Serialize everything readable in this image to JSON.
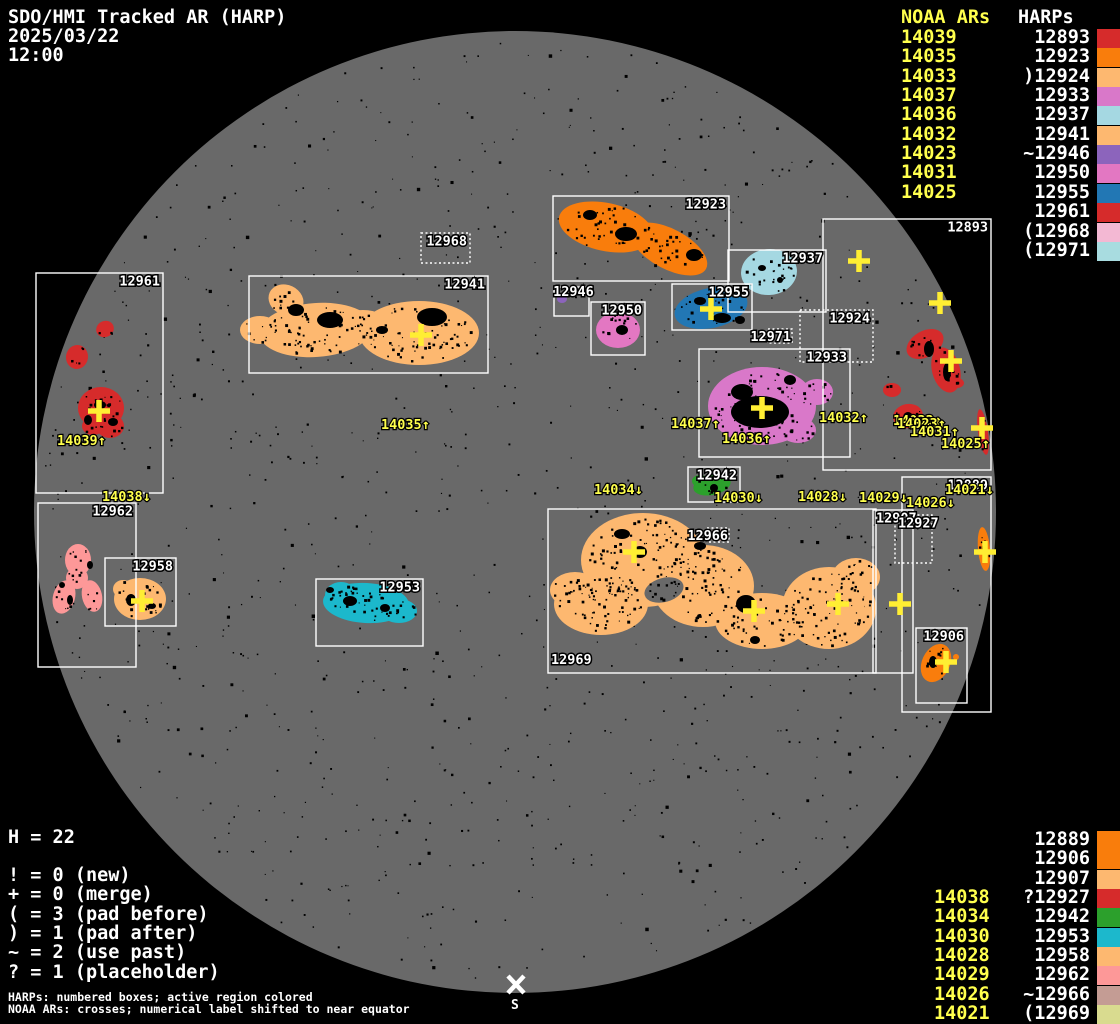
{
  "title": {
    "app": "SDO/HMI Tracked AR (HARP)",
    "date": "2025/03/22",
    "time": "12:00"
  },
  "top_legend": {
    "noaa_header": "NOAA ARs",
    "harp_header": "HARPs",
    "rows": [
      {
        "noaa": "14039",
        "prefix": "",
        "harp": "12893",
        "color": "#d62b2b"
      },
      {
        "noaa": "14035",
        "prefix": "",
        "harp": "12923",
        "color": "#f97d0c"
      },
      {
        "noaa": "14033",
        "prefix": ")",
        "harp": "12924",
        "color": "#fdb870"
      },
      {
        "noaa": "14037",
        "prefix": "",
        "harp": "12933",
        "color": "#d978c9"
      },
      {
        "noaa": "14036",
        "prefix": "",
        "harp": "12937",
        "color": "#a5d8e2"
      },
      {
        "noaa": "14032",
        "prefix": "",
        "harp": "12941",
        "color": "#fdb870"
      },
      {
        "noaa": "14023",
        "prefix": "~",
        "harp": "12946",
        "color": "#8c64bc"
      },
      {
        "noaa": "14031",
        "prefix": "",
        "harp": "12950",
        "color": "#e377c2"
      },
      {
        "noaa": "14025",
        "prefix": "",
        "harp": "12955",
        "color": "#2277b4"
      },
      {
        "noaa": "",
        "prefix": "",
        "harp": "12961",
        "color": "#d62b2b"
      },
      {
        "noaa": "",
        "prefix": "(",
        "harp": "12968",
        "color": "#f3b8d3"
      },
      {
        "noaa": "",
        "prefix": "(",
        "harp": "12971",
        "color": "#a8dce0"
      }
    ]
  },
  "bottom_legend": {
    "rows": [
      {
        "noaa": "",
        "prefix": "",
        "harp": "12889",
        "color": "#f97d0c"
      },
      {
        "noaa": "",
        "prefix": "",
        "harp": "12906",
        "color": "#f97d0c"
      },
      {
        "noaa": "",
        "prefix": "",
        "harp": "12907",
        "color": "#fdb870"
      },
      {
        "noaa": "14038",
        "prefix": "?",
        "harp": "12927",
        "color": "#d62b2b"
      },
      {
        "noaa": "14034",
        "prefix": "",
        "harp": "12942",
        "color": "#2ca02c"
      },
      {
        "noaa": "14030",
        "prefix": "",
        "harp": "12953",
        "color": "#1cb8cc"
      },
      {
        "noaa": "14028",
        "prefix": "",
        "harp": "12958",
        "color": "#fdb870"
      },
      {
        "noaa": "14029",
        "prefix": "",
        "harp": "12962",
        "color": "#fd9898"
      },
      {
        "noaa": "14026",
        "prefix": "~",
        "harp": "12966",
        "color": "#c49c94"
      },
      {
        "noaa": "14021",
        "prefix": "(",
        "harp": "12969",
        "color": "#d9db8f"
      }
    ]
  },
  "counters": {
    "h_line": "H = 22",
    "items": [
      "! = 0 (new)",
      "+ = 0 (merge)",
      "( = 3 (pad before)",
      ") = 1 (pad after)",
      "~ = 2 (use past)",
      "? = 1 (placeholder)"
    ]
  },
  "footnotes": {
    "line1": "HARPs: numbered boxes; active region colored",
    "line2": "NOAA ARs: crosses; numerical label shifted to near equator"
  },
  "south_label": "S",
  "disk": {
    "cx": 515,
    "cy": 512,
    "r": 481,
    "color": "#696969",
    "background": "#000000",
    "cross_color": "#ffee33",
    "label_color": "#ffff4d"
  },
  "boxes": [
    {
      "label": "12961",
      "x": 36,
      "y": 273,
      "w": 127,
      "h": 220,
      "dotted": false,
      "anchor": "tr"
    },
    {
      "label": "12962",
      "x": 38,
      "y": 503,
      "w": 98,
      "h": 164,
      "dotted": false,
      "anchor": "tr"
    },
    {
      "label": "12958",
      "x": 105,
      "y": 558,
      "w": 71,
      "h": 68,
      "dotted": false,
      "anchor": "tr"
    },
    {
      "label": "12941",
      "x": 249,
      "y": 276,
      "w": 239,
      "h": 97,
      "dotted": false,
      "anchor": "tr"
    },
    {
      "label": "12968",
      "x": 421,
      "y": 233,
      "w": 49,
      "h": 30,
      "dotted": true,
      "anchor": "tr"
    },
    {
      "label": "12923",
      "x": 553,
      "y": 196,
      "w": 176,
      "h": 85,
      "dotted": false,
      "anchor": "tr"
    },
    {
      "label": "12946",
      "x": 554,
      "y": 287,
      "w": 35,
      "h": 29,
      "dotted": false,
      "anchor": "tc"
    },
    {
      "label": "12950",
      "x": 591,
      "y": 302,
      "w": 54,
      "h": 53,
      "dotted": false,
      "anchor": "tr"
    },
    {
      "label": "12955",
      "x": 672,
      "y": 284,
      "w": 80,
      "h": 46,
      "dotted": false,
      "anchor": "tr"
    },
    {
      "label": "12937",
      "x": 728,
      "y": 250,
      "w": 98,
      "h": 62,
      "dotted": false,
      "anchor": "tr"
    },
    {
      "label": "12924",
      "x": 800,
      "y": 310,
      "w": 73,
      "h": 52,
      "dotted": true,
      "anchor": "tr"
    },
    {
      "label": "12933",
      "x": 699,
      "y": 349,
      "w": 151,
      "h": 108,
      "dotted": false,
      "anchor": "tr"
    },
    {
      "label": "12893",
      "x": 823,
      "y": 219,
      "w": 168,
      "h": 251,
      "dotted": false,
      "anchor": "tr"
    },
    {
      "label": "12971",
      "x": 768,
      "y": 329,
      "w": 24,
      "h": 14,
      "dotted": true,
      "anchor": "lr"
    },
    {
      "label": "12942",
      "x": 688,
      "y": 467,
      "w": 52,
      "h": 35,
      "dotted": false,
      "anchor": "tr"
    },
    {
      "label": "12969",
      "x": 548,
      "y": 509,
      "w": 328,
      "h": 164,
      "dotted": false,
      "anchor": "bl"
    },
    {
      "label": "12966",
      "x": 707,
      "y": 528,
      "w": 22,
      "h": 14,
      "dotted": true,
      "anchor": "lr"
    },
    {
      "label": "12953",
      "x": 316,
      "y": 579,
      "w": 107,
      "h": 67,
      "dotted": false,
      "anchor": "tr"
    },
    {
      "label": "12889",
      "x": 902,
      "y": 477,
      "w": 89,
      "h": 235,
      "dotted": false,
      "anchor": "tr"
    },
    {
      "label": "12907",
      "x": 873,
      "y": 510,
      "w": 40,
      "h": 163,
      "dotted": false,
      "anchor": "tl"
    },
    {
      "label": "12927",
      "x": 895,
      "y": 515,
      "w": 37,
      "h": 48,
      "dotted": true,
      "anchor": "tl"
    },
    {
      "label": "12906",
      "x": 916,
      "y": 628,
      "w": 51,
      "h": 75,
      "dotted": false,
      "anchor": "tr"
    }
  ],
  "regions": [
    {
      "name": "harp-12961",
      "color": "#d62b2b",
      "parts": [
        [
          105,
          329,
          9,
          8,
          -25
        ],
        [
          77,
          357,
          11,
          12,
          10
        ],
        [
          101,
          408,
          23,
          21,
          0
        ],
        [
          110,
          426,
          14,
          12,
          0
        ],
        [
          93,
          426,
          11,
          9,
          0
        ]
      ],
      "cores": [
        [
          100,
          405,
          6,
          4
        ],
        [
          88,
          420,
          4,
          5
        ],
        [
          113,
          422,
          5,
          4
        ]
      ]
    },
    {
      "name": "harp-12962",
      "color": "#fd9898",
      "parts": [
        [
          78,
          560,
          13,
          16,
          0
        ],
        [
          64,
          597,
          11,
          17,
          15
        ],
        [
          92,
          596,
          10,
          16,
          -12
        ],
        [
          77,
          578,
          11,
          11,
          0
        ]
      ],
      "cores": [
        [
          70,
          600,
          3,
          5
        ],
        [
          90,
          565,
          3,
          4
        ],
        [
          62,
          585,
          3,
          3
        ]
      ]
    },
    {
      "name": "harp-12958",
      "color": "#fdb870",
      "parts": [
        [
          140,
          599,
          26,
          21,
          0
        ],
        [
          123,
          589,
          10,
          9,
          0
        ]
      ],
      "cores": [
        [
          131,
          600,
          5,
          6
        ],
        [
          152,
          606,
          4,
          3
        ]
      ]
    },
    {
      "name": "harp-12941",
      "color": "#fdb870",
      "parts": [
        [
          316,
          330,
          57,
          27,
          -4
        ],
        [
          286,
          300,
          18,
          15,
          25
        ],
        [
          419,
          333,
          60,
          32,
          0
        ],
        [
          363,
          324,
          26,
          14,
          0
        ],
        [
          260,
          330,
          20,
          14,
          0
        ]
      ],
      "cores": [
        [
          330,
          320,
          13,
          8
        ],
        [
          432,
          317,
          15,
          9
        ],
        [
          296,
          310,
          8,
          6
        ],
        [
          382,
          330,
          6,
          4
        ]
      ]
    },
    {
      "name": "harp-12923",
      "color": "#f97d0c",
      "parts": [
        [
          606,
          227,
          48,
          24,
          12
        ],
        [
          669,
          249,
          42,
          20,
          28
        ]
      ],
      "cores": [
        [
          626,
          234,
          11,
          7
        ],
        [
          694,
          255,
          8,
          6
        ],
        [
          590,
          215,
          7,
          5
        ]
      ]
    },
    {
      "name": "harp-12946",
      "color": "#8c64bc",
      "parts": [
        [
          562,
          299,
          5,
          4,
          0
        ]
      ],
      "cores": []
    },
    {
      "name": "harp-12950",
      "color": "#e377c2",
      "parts": [
        [
          618,
          330,
          22,
          18,
          0
        ]
      ],
      "cores": [
        [
          622,
          330,
          6,
          5
        ]
      ]
    },
    {
      "name": "harp-12955",
      "color": "#2277b4",
      "parts": [
        [
          711,
          308,
          37,
          20,
          -12
        ]
      ],
      "cores": [
        [
          722,
          318,
          9,
          5
        ],
        [
          700,
          301,
          6,
          4
        ],
        [
          740,
          320,
          5,
          4
        ]
      ]
    },
    {
      "name": "harp-12937",
      "color": "#a5d8e2",
      "parts": [
        [
          769,
          272,
          28,
          23,
          -5
        ]
      ],
      "cores": [
        [
          762,
          268,
          4,
          3
        ],
        [
          780,
          280,
          3,
          3
        ]
      ]
    },
    {
      "name": "harp-12933",
      "color": "#d978c9",
      "parts": [
        [
          762,
          406,
          54,
          39,
          0
        ],
        [
          817,
          392,
          16,
          13,
          0
        ],
        [
          798,
          430,
          18,
          13,
          0
        ]
      ],
      "cores": [
        [
          760,
          412,
          29,
          16
        ],
        [
          742,
          392,
          11,
          8
        ],
        [
          790,
          380,
          6,
          5
        ]
      ]
    },
    {
      "name": "harp-12893",
      "color": "#d62b2b",
      "parts": [
        [
          925,
          344,
          20,
          13,
          -30
        ],
        [
          946,
          370,
          14,
          23,
          -15
        ],
        [
          892,
          390,
          9,
          7,
          0
        ],
        [
          908,
          416,
          15,
          12,
          -10
        ],
        [
          957,
          383,
          7,
          5,
          0
        ],
        [
          983,
          432,
          5,
          23,
          -8
        ]
      ],
      "cores": [
        [
          929,
          349,
          5,
          8
        ],
        [
          947,
          372,
          4,
          9
        ],
        [
          908,
          417,
          5,
          5
        ]
      ]
    },
    {
      "name": "harp-12942",
      "color": "#2ca02c",
      "parts": [
        [
          712,
          485,
          19,
          10,
          -12
        ],
        [
          700,
          481,
          8,
          6,
          0
        ]
      ],
      "cores": [
        [
          714,
          488,
          4,
          4
        ]
      ]
    },
    {
      "name": "harp-12969",
      "color": "#fdb870",
      "parts": [
        [
          643,
          560,
          62,
          47,
          0
        ],
        [
          601,
          604,
          47,
          31,
          0
        ],
        [
          703,
          586,
          51,
          41,
          0
        ],
        [
          762,
          621,
          47,
          28,
          0
        ],
        [
          829,
          608,
          47,
          41,
          0
        ],
        [
          856,
          577,
          24,
          19,
          0
        ],
        [
          575,
          590,
          25,
          18,
          0
        ]
      ],
      "holes": [
        [
          664,
          590,
          20,
          12,
          -15
        ]
      ],
      "cores": [
        [
          746,
          604,
          10,
          9
        ],
        [
          640,
          552,
          7,
          6
        ],
        [
          622,
          534,
          8,
          5
        ],
        [
          700,
          546,
          6,
          4
        ],
        [
          755,
          640,
          5,
          4
        ]
      ]
    },
    {
      "name": "harp-12966",
      "color": "#c49c94",
      "parts": [
        [
          718,
          535,
          9,
          6,
          0
        ]
      ],
      "cores": []
    },
    {
      "name": "harp-12953",
      "color": "#1cb8cc",
      "parts": [
        [
          366,
          603,
          43,
          20,
          3
        ],
        [
          341,
          595,
          16,
          13,
          0
        ],
        [
          399,
          611,
          18,
          12,
          0
        ]
      ],
      "cores": [
        [
          350,
          601,
          7,
          5
        ],
        [
          385,
          608,
          5,
          4
        ],
        [
          330,
          590,
          4,
          3
        ]
      ]
    },
    {
      "name": "harp-12906",
      "color": "#f97d0c",
      "parts": [
        [
          936,
          663,
          14,
          20,
          25
        ],
        [
          956,
          657,
          3,
          3,
          0
        ]
      ],
      "cores": [
        [
          933,
          662,
          4,
          6
        ]
      ]
    },
    {
      "name": "harp-12907-limb",
      "color": "#f97d0c",
      "parts": [
        [
          984,
          549,
          6,
          22,
          -5
        ]
      ],
      "cores": [
        [
          984,
          549,
          2,
          6
        ]
      ]
    },
    {
      "name": "harp-12889-sliver",
      "color": "#fdb870",
      "parts": [
        [
          869,
          600,
          5,
          12,
          0
        ]
      ],
      "cores": []
    }
  ],
  "crosses": [
    [
      99,
      411
    ],
    [
      421,
      335
    ],
    [
      142,
      601
    ],
    [
      711,
      309
    ],
    [
      762,
      408
    ],
    [
      859,
      261
    ],
    [
      940,
      303
    ],
    [
      951,
      361
    ],
    [
      982,
      428
    ],
    [
      634,
      552
    ],
    [
      754,
      611
    ],
    [
      838,
      604
    ],
    [
      900,
      604
    ],
    [
      985,
      552
    ],
    [
      946,
      662
    ]
  ],
  "ar_labels": [
    {
      "t": "14039↑",
      "x": 57,
      "y": 445
    },
    {
      "t": "14038↓",
      "x": 102,
      "y": 501
    },
    {
      "t": "14035↑",
      "x": 381,
      "y": 429
    },
    {
      "t": "14037↑",
      "x": 671,
      "y": 428
    },
    {
      "t": "14036↑",
      "x": 722,
      "y": 443
    },
    {
      "t": "14032↑",
      "x": 819,
      "y": 422
    },
    {
      "t": "14033↑",
      "x": 893,
      "y": 425
    },
    {
      "t": "14023↑",
      "x": 897,
      "y": 428
    },
    {
      "t": "14031↑",
      "x": 910,
      "y": 436
    },
    {
      "t": "14025↑",
      "x": 941,
      "y": 448
    },
    {
      "t": "14034↓",
      "x": 594,
      "y": 494
    },
    {
      "t": "14030↓",
      "x": 714,
      "y": 502
    },
    {
      "t": "14028↓",
      "x": 798,
      "y": 501
    },
    {
      "t": "14029↓",
      "x": 859,
      "y": 502
    },
    {
      "t": "14026↓",
      "x": 906,
      "y": 507
    },
    {
      "t": "14021↓",
      "x": 945,
      "y": 494
    }
  ],
  "chart_data": {
    "type": "map",
    "title": "SDO/HMI Tracked AR (HARP)",
    "timestamp": "2025/03/22 12:00",
    "harp_count": 22,
    "tracked_harps": [
      "12889",
      "12893",
      "12906",
      "12907",
      "12923",
      "12924",
      "12927",
      "12933",
      "12937",
      "12941",
      "12942",
      "12946",
      "12950",
      "12953",
      "12955",
      "12958",
      "12961",
      "12962",
      "12966",
      "12968",
      "12969",
      "12971"
    ],
    "noaa_ars": [
      "14021",
      "14023",
      "14025",
      "14026",
      "14028",
      "14029",
      "14030",
      "14031",
      "14032",
      "14033",
      "14034",
      "14035",
      "14036",
      "14037",
      "14038",
      "14039"
    ],
    "status_counts": {
      "new": 0,
      "merge": 0,
      "pad_before": 3,
      "pad_after": 1,
      "use_past": 2,
      "placeholder": 1
    },
    "prefix_flags": {
      ")": "pad after",
      "(": "pad before",
      "~": "use past",
      "?": "placeholder",
      "!": "new",
      "+": "merge"
    }
  }
}
